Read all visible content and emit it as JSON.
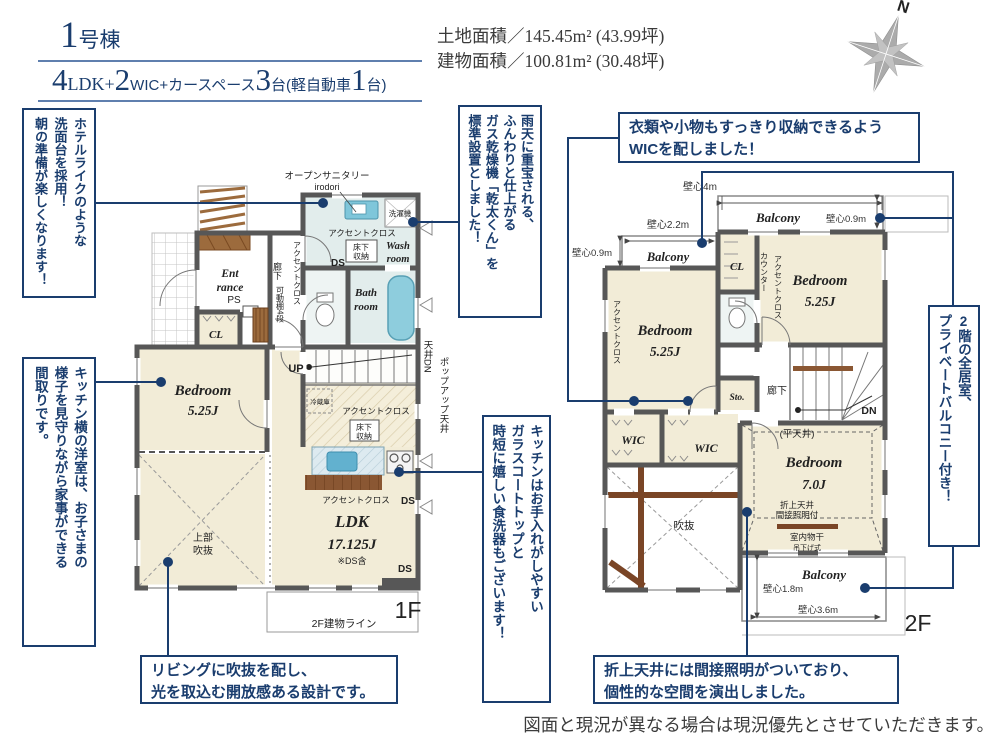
{
  "header": {
    "no_num": "1",
    "no_suffix": "号棟",
    "layout": [
      "4",
      "LDK+",
      "2",
      "WIC+カースペース",
      "3",
      "台(軽自動車",
      "1",
      "台)"
    ],
    "land": "土地面積／145.45m² (43.99坪)",
    "building": "建物面積／100.81m² (30.48坪)",
    "north": "N"
  },
  "callouts": {
    "hotel": [
      "ホテルライクのような",
      "洗面台を採用！",
      "朝の準備が楽しくなります！"
    ],
    "kitchen_side": [
      "キッチン横の洋室は、お子さまの",
      "様子を見守りながら家事ができる",
      "間取りです。"
    ],
    "kanta": [
      "雨天に重宝される、",
      "ふんわりと仕上がる",
      "ガス乾燥機「乾太くん」を",
      "標準設置としました！"
    ],
    "kitchen": [
      "キッチンはお手入れがしやすい",
      "ガラスコートトップと",
      "時短に嬉しい食洗器もございます！"
    ],
    "wic": [
      "衣類や小物もすっきり収納できるよう",
      "WICを配しました！"
    ],
    "balcony": [
      "2階の全居室、",
      "プライベートバルコニー付き！"
    ],
    "living": [
      "リビングに吹抜を配し、",
      "光を取込む開放感ある設計です。"
    ],
    "oriage": [
      "折上天井には間接照明がついており、",
      "個性的な空間を演出しました。"
    ]
  },
  "common": {
    "accent": "アクセントクロス",
    "ds": "DS",
    "bedroom": "Bedroom",
    "size525": "5.25J",
    "wic": "WIC",
    "balcony": "Balcony",
    "yuka1": "床下",
    "yuka2": "収納",
    "h09": "壁心0.9m"
  },
  "p1": {
    "open_sanitary": "オープンサニタリー",
    "irodori": "irodori",
    "washer": "洗濯機",
    "wash1": "Wash",
    "wash2": "room",
    "bath1": "Bath",
    "bath2": "room",
    "ent1": "Ent",
    "ent2": "rance",
    "ps": "PS",
    "cl": "CL",
    "rouka": "廊下",
    "kadou": "可動棚4段",
    "up": "UP",
    "tenjo_dn": "天井DN",
    "popup": "ポップアップ天井",
    "reizo": "冷蔵庫",
    "joubu1": "上部",
    "joubu2": "吹抜",
    "ldk": "LDK",
    "ldk_size": "17.125J",
    "ldk_note": "※DS含",
    "floor": "1F",
    "bline": "2F建物ライン"
  },
  "p2": {
    "h4": "壁心4m",
    "h22": "壁心2.2m",
    "h18": "壁心1.8m",
    "h36": "壁心3.6m",
    "cl": "CL",
    "counter": "カウンター",
    "sto": "Sto.",
    "rouka": "廊下",
    "dn": "DN",
    "hira": "(平天井)",
    "b7": "Bedroom",
    "b7size": "7.0J",
    "oriage1": "折上天井",
    "oriage2": "間接照明付",
    "mono1": "室内物干",
    "mono2": "吊下げ式",
    "fukinuke": "吹抜",
    "floor": "2F"
  },
  "footer": {
    "disclaimer": "図面と現況が異なる場合は現況優先とさせていただきます。"
  },
  "colors": {
    "navy": "#1a3d6e",
    "wall": "#575757",
    "room": "#f2ecd7",
    "wet": "#e2edec",
    "tub": "#8ecddd"
  }
}
